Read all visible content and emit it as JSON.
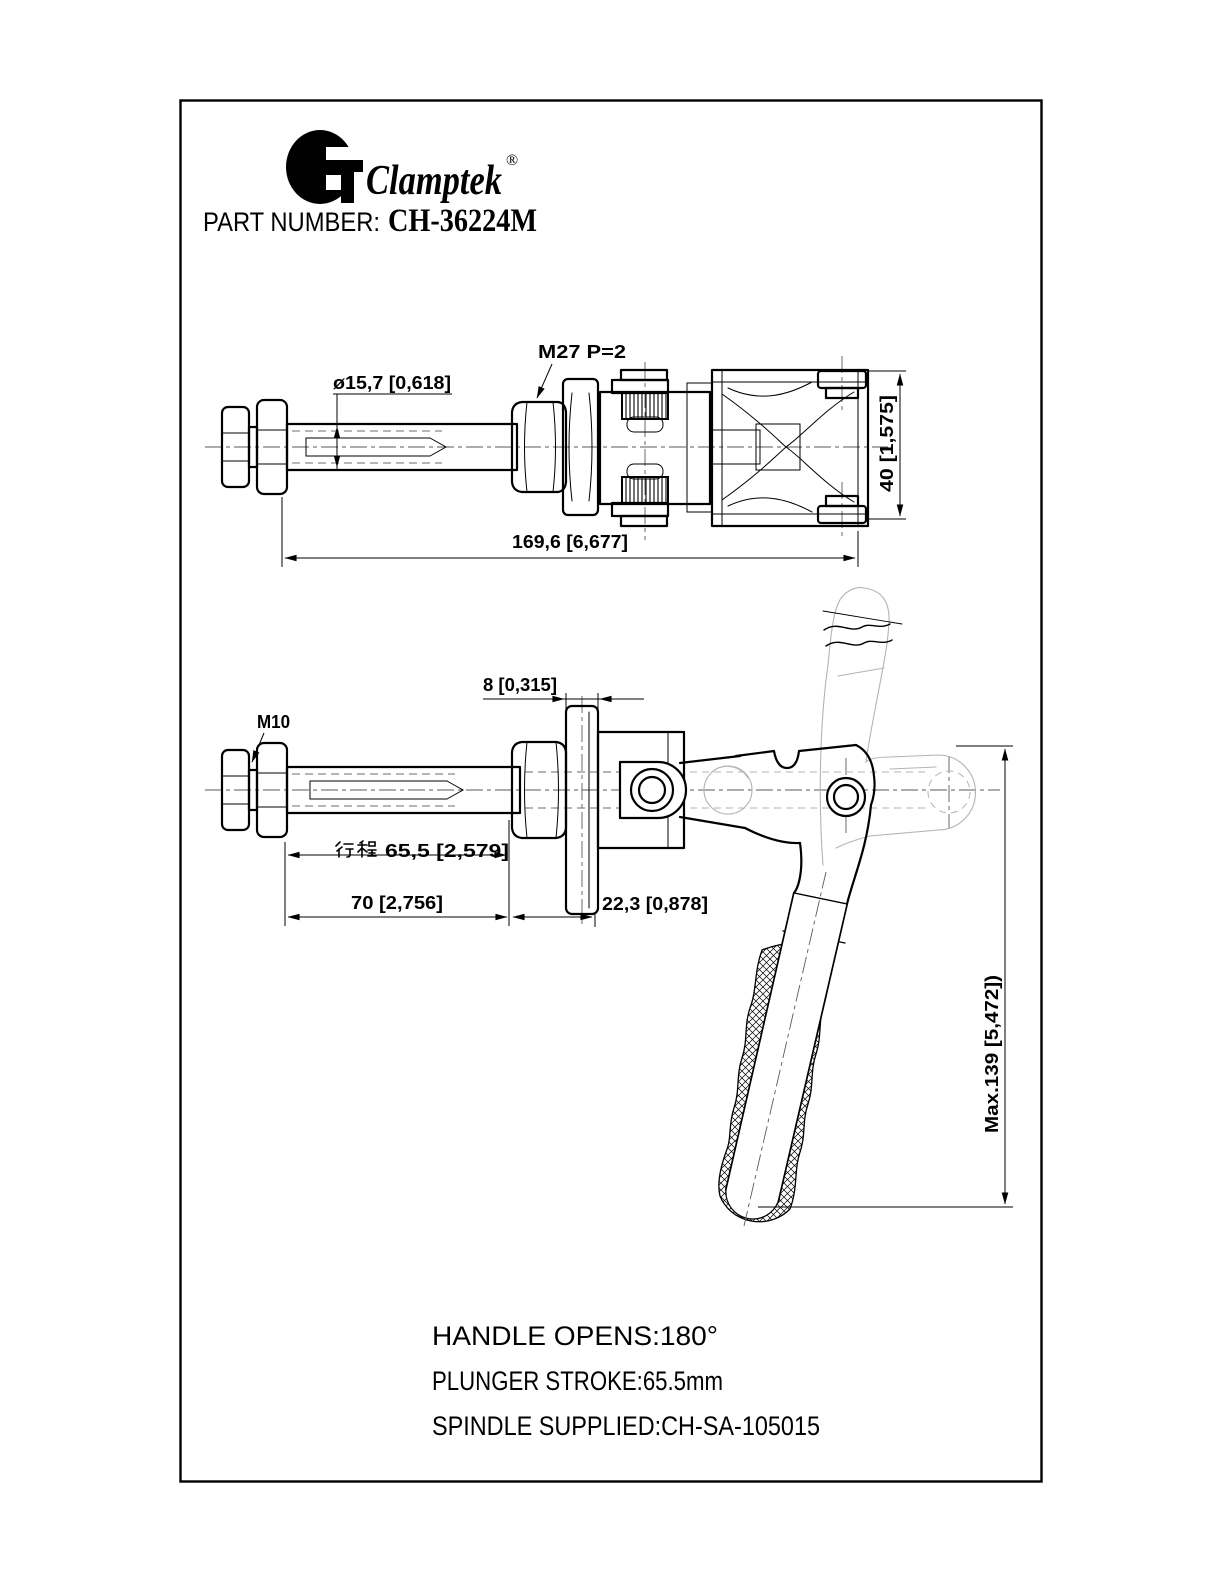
{
  "header": {
    "brand": "Clamptek",
    "registered": "®",
    "part_number_label": "PART NUMBER:",
    "part_number_value": "CH-36224M"
  },
  "top_view": {
    "labels": {
      "thread_spec": "M27 P=2",
      "plunger_diameter": "ø15,7 [0,618]",
      "overall_length": "169,6 [6,677]",
      "body_height": "40 [1,575]"
    }
  },
  "bottom_view": {
    "labels": {
      "spindle_thread": "M10",
      "flange_width": "8 [0,315]",
      "stroke_full": "行程65,5 [2,579]",
      "stroke_value": "65,5 [2,579]",
      "shaft_extension": "70 [2,756]",
      "body_offset": "22,3 [0,878]",
      "max_height": "Max.139 [5,472])"
    }
  },
  "specs": {
    "handle_opens": "HANDLE OPENS:180°",
    "plunger_stroke": "PLUNGER STROKE:65.5mm",
    "spindle_supplied": "SPINDLE SUPPLIED:CH-SA-105015"
  },
  "colors": {
    "line": "#000000",
    "ghost": "#b3b3b3",
    "centerline": "#5a5a5a",
    "background": "#ffffff"
  }
}
